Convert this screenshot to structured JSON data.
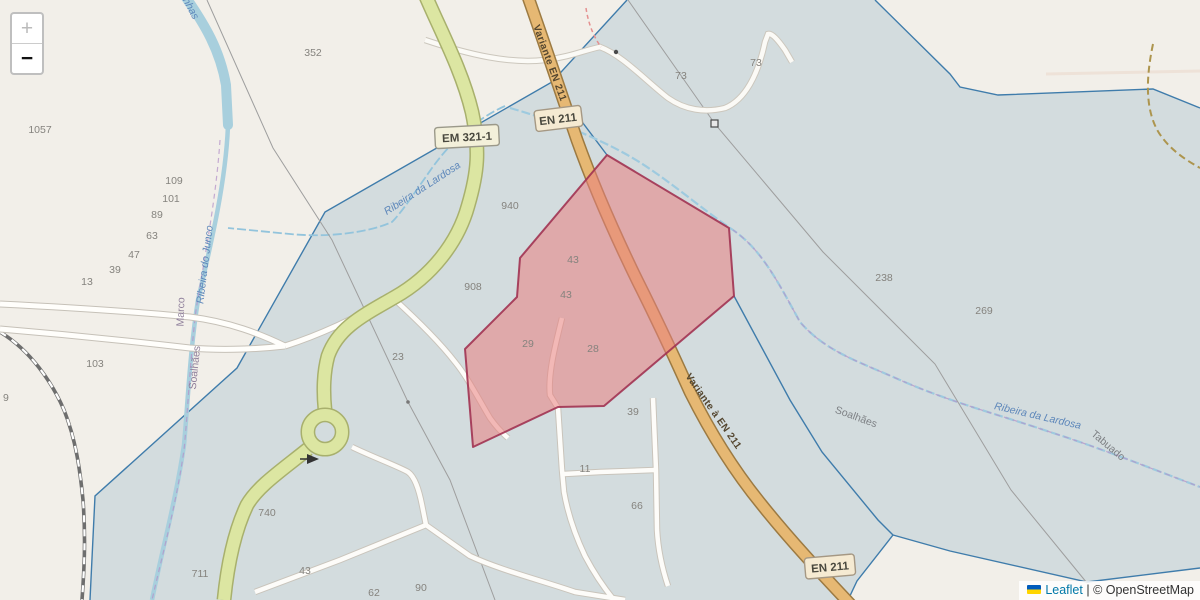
{
  "zoom_control": {
    "zoom_in": "+",
    "zoom_out": "−"
  },
  "attribution": {
    "flag_icon": "ukraine-flag",
    "leaflet_link": "Leaflet",
    "separator": "|",
    "osm_text": "© OpenStreetMap"
  },
  "road_labels": {
    "em321_badge": "EM 321-1",
    "en211_badge_top": "EN 211",
    "en211_badge_bottom": "EN 211",
    "variante_top": "Variante EN 211",
    "variante_bottom": "Variante à EN 211"
  },
  "water_labels": {
    "top_fragment": "nhas",
    "junco": "Ribeira do Junco",
    "lardosa_left": "Ribeira da Lardosa",
    "lardosa_right": "Ribeira da Lardosa"
  },
  "place_labels": {
    "marco": "Marco",
    "soalhaes_west": "Soalhães",
    "soalhaes_east": "Soalhães",
    "tabuado": "Tabuado"
  },
  "parcel_numbers": [
    {
      "value": "352"
    },
    {
      "value": "1057"
    },
    {
      "value": "109"
    },
    {
      "value": "101"
    },
    {
      "value": "89"
    },
    {
      "value": "63"
    },
    {
      "value": "47"
    },
    {
      "value": "39"
    },
    {
      "value": "13"
    },
    {
      "value": "103"
    },
    {
      "value": "9"
    },
    {
      "value": "23"
    },
    {
      "value": "940"
    },
    {
      "value": "908"
    },
    {
      "value": "43"
    },
    {
      "value": "43"
    },
    {
      "value": "29"
    },
    {
      "value": "28"
    },
    {
      "value": "39"
    },
    {
      "value": "11"
    },
    {
      "value": "66"
    },
    {
      "value": "740"
    },
    {
      "value": "711"
    },
    {
      "value": "43"
    },
    {
      "value": "62"
    },
    {
      "value": "90"
    },
    {
      "value": "73"
    },
    {
      "value": "73"
    },
    {
      "value": "238"
    },
    {
      "value": "269"
    }
  ],
  "colors": {
    "land": "#f2efe9",
    "zone_fill": "#d3dcde",
    "zone_boundary": "#3f7cab",
    "selected_parcel_fill": "#ea8080",
    "selected_parcel_border": "#a13352",
    "road_primary": "#e6b873",
    "road_tertiary": "#dce6a2",
    "river": "#a8cfdd"
  }
}
